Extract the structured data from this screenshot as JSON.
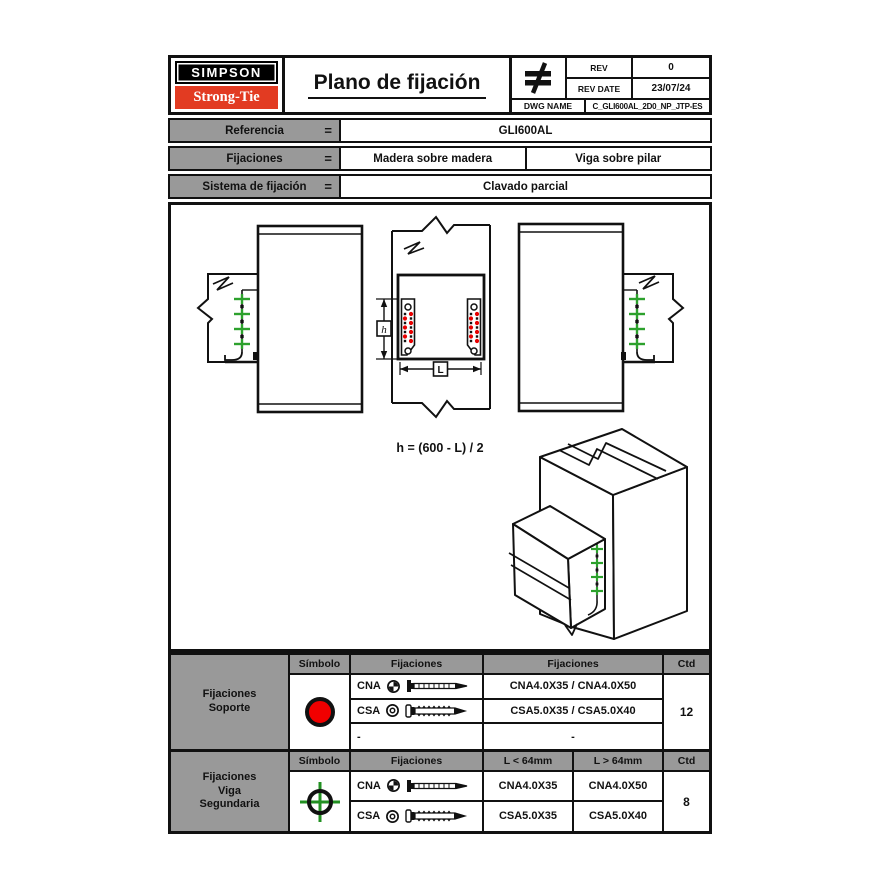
{
  "header": {
    "brand_line1": "SIMPSON",
    "brand_line2": "Strong-Tie",
    "title": "Plano de fijación",
    "rev_label": "REV",
    "rev_value": "0",
    "rev_date_label": "REV DATE",
    "rev_date_value": "23/07/24",
    "dwg_name_label": "DWG NAME",
    "dwg_name_value": "C_GLI600AL_2D0_NP_JTP-ES"
  },
  "reference": {
    "rows": [
      {
        "label": "Referencia",
        "eq": "=",
        "values": [
          "GLI600AL"
        ]
      },
      {
        "label": "Fijaciones",
        "eq": "=",
        "values": [
          "Madera sobre madera",
          "Viga sobre pilar"
        ]
      },
      {
        "label": "Sistema de fijación",
        "eq": "=",
        "values": [
          "Clavado parcial"
        ]
      }
    ]
  },
  "drawing": {
    "formula": "h = (600 - L) / 2",
    "dim_height_label": "h",
    "dim_length_label": "L"
  },
  "fixings_support": {
    "row_label_lines": [
      "Fijaciones",
      "Soporte"
    ],
    "col_simbolo": "Símbolo",
    "col_fijaciones_icon": "Fijaciones",
    "col_fijaciones_name": "Fijaciones",
    "col_ctd": "Ctd",
    "symbol": "red-circle",
    "rows": [
      {
        "code": "CNA",
        "name": "CNA4.0X35 / CNA4.0X50"
      },
      {
        "code": "CSA",
        "name": "CSA5.0X35 / CSA5.0X40"
      },
      {
        "code": "-",
        "name": "-"
      }
    ],
    "ctd": "12"
  },
  "fixings_beam": {
    "row_label_lines": [
      "Fijaciones",
      "Viga",
      "Segundaria"
    ],
    "col_simbolo": "Símbolo",
    "col_fijaciones": "Fijaciones",
    "col_l_lt": "L < 64mm",
    "col_l_gt": "L > 64mm",
    "col_ctd": "Ctd",
    "symbol": "green-crosshair",
    "rows": [
      {
        "code": "CNA",
        "lt": "CNA4.0X35",
        "gt": "CNA4.0X50"
      },
      {
        "code": "CSA",
        "lt": "CSA5.0X35",
        "gt": "CSA5.0X40"
      }
    ],
    "ctd": "8"
  },
  "symbols": {
    "brand_mark": "not-equal-mark",
    "support_fixing": "red-circle",
    "secondary_beam_fixing": "green-crosshair",
    "nail_top": "nail-head-icon",
    "screw_top": "screw-head-icon"
  },
  "colors": {
    "header_gray": "#999999",
    "brand_red": "#e23b22",
    "fixing_red": "#f10000",
    "nail_green": "#2da12d"
  }
}
